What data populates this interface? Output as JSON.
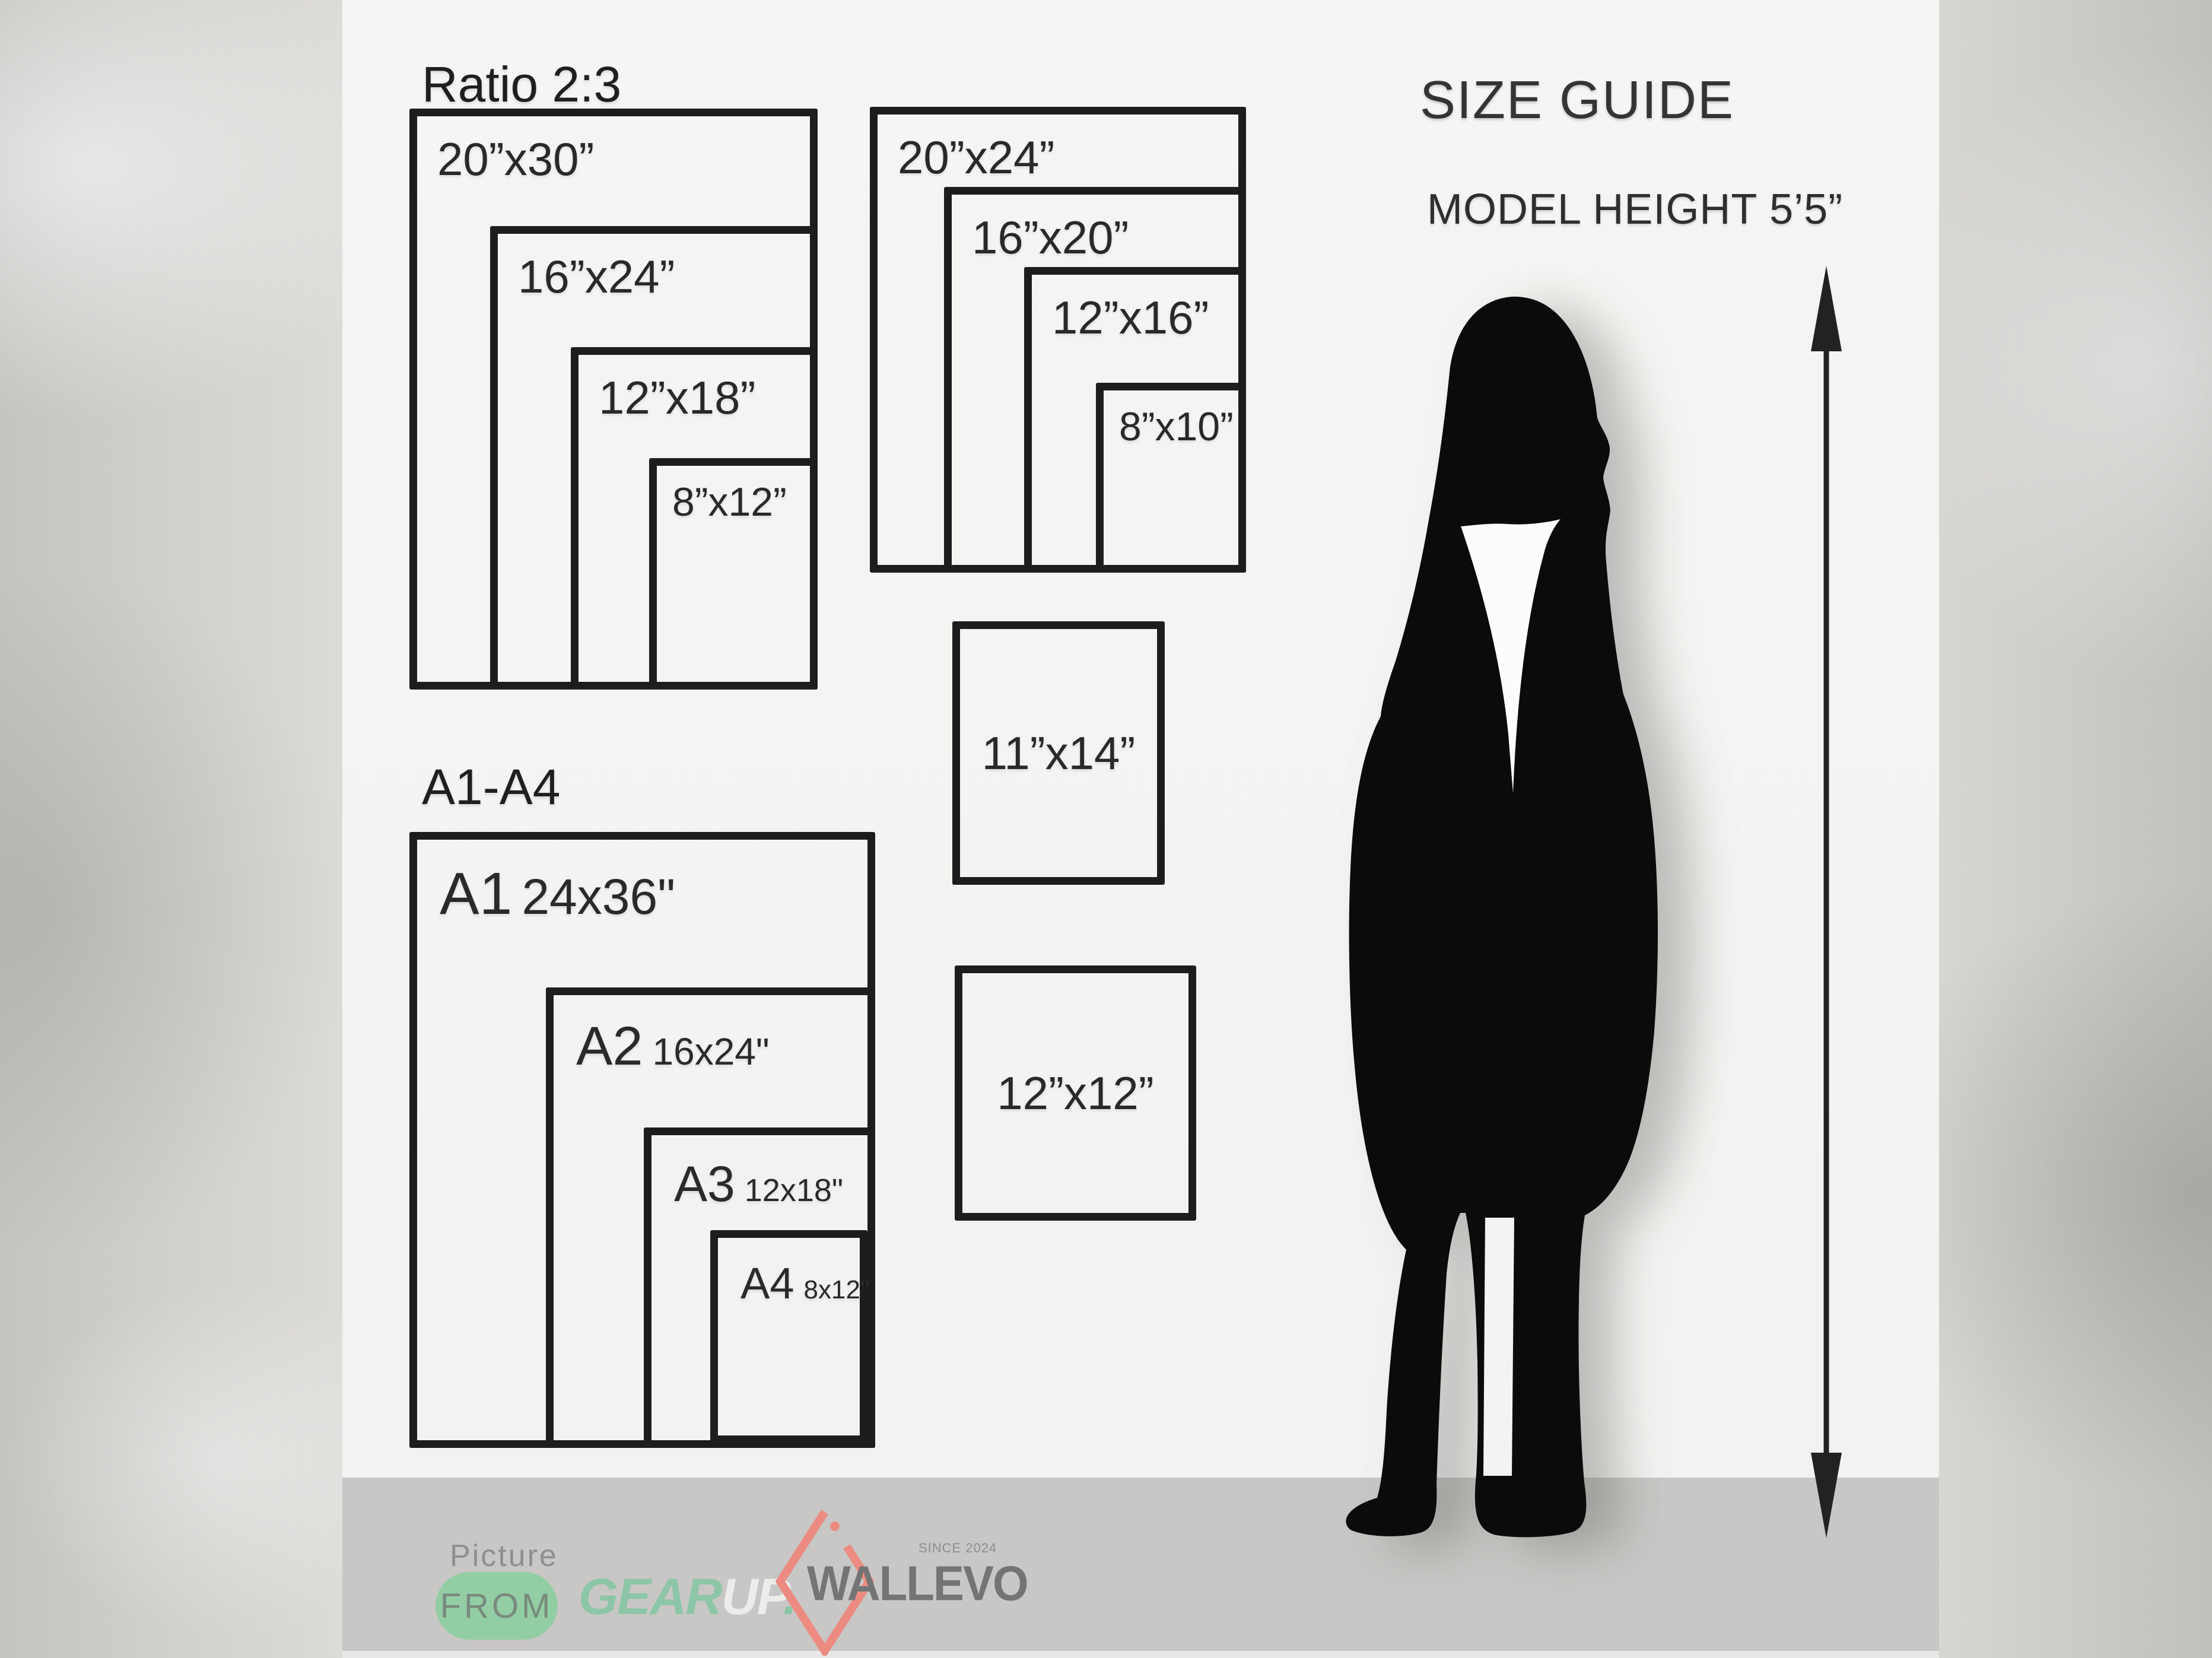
{
  "header": {
    "title": "SIZE GUIDE",
    "model_height": "MODEL HEIGHT 5’5”"
  },
  "ratio_group": {
    "heading": "Ratio 2:3",
    "boxes": [
      {
        "label": "20”x30”"
      },
      {
        "label": "16”x24”"
      },
      {
        "label": "12”x18”"
      },
      {
        "label": "8”x12”"
      }
    ]
  },
  "standard_group": {
    "boxes": [
      {
        "label": "20”x24”"
      },
      {
        "label": "16”x20”"
      },
      {
        "label": "12”x16”"
      },
      {
        "label": "8”x10”"
      }
    ]
  },
  "single_boxes": [
    {
      "label": "11”x14”"
    },
    {
      "label": "12”x12”"
    }
  ],
  "a_group": {
    "heading": "A1-A4",
    "boxes": [
      {
        "name": "A1",
        "size": "24x36\""
      },
      {
        "name": "A2",
        "size": "16x24\""
      },
      {
        "name": "A3",
        "size": "12x18\""
      },
      {
        "name": "A4",
        "size": "8x12\""
      }
    ]
  },
  "footer": {
    "picture_label": "Picture",
    "from_label": "FROM",
    "gearup": {
      "gear": "GEAR",
      "up": "UP",
      "dot": "."
    },
    "wallevo": {
      "brand": "WALLEVO",
      "since": "SINCE 2024"
    }
  },
  "colors": {
    "box_border": "#1d1d1d",
    "sheet_white": "#f5f4f2",
    "background_grey": "#d6d4d1",
    "footer_band": "#c8c7c5",
    "from_badge_green": "#93cda4",
    "gear_green": "#8cc6a6",
    "up_white": "#ececea",
    "wallevo_grey": "#747474",
    "diamond_salmon": "#ec8b81",
    "silhouette_black": "#0b0b0b"
  }
}
